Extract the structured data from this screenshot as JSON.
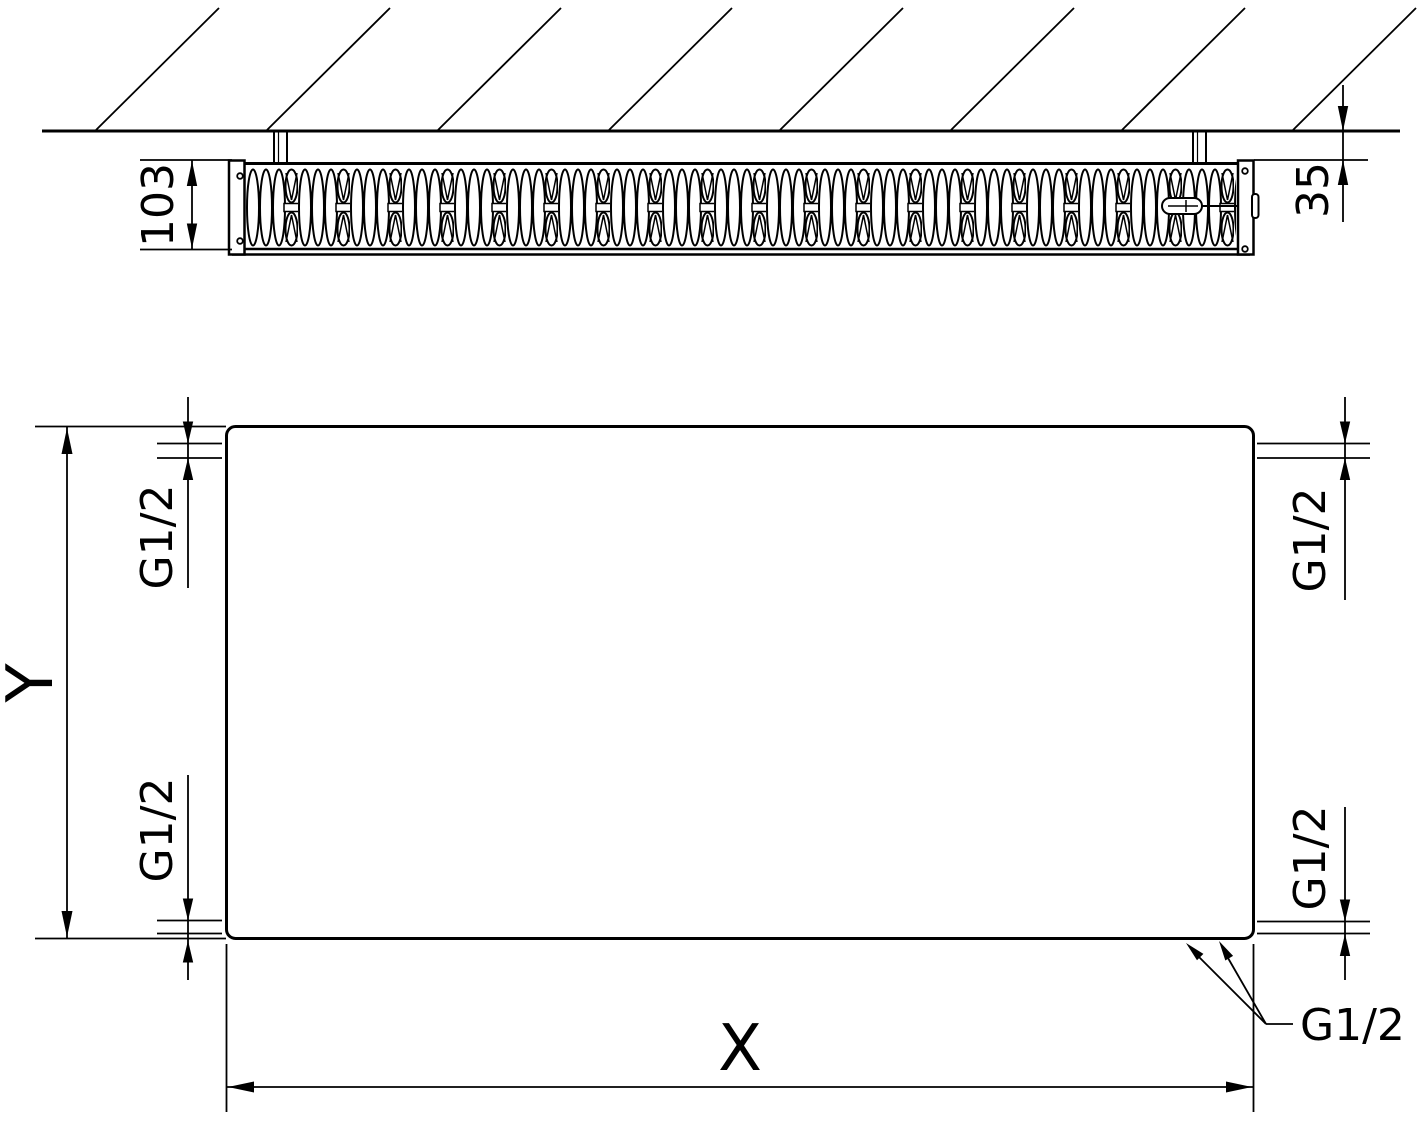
{
  "top_view": {
    "depth_dim_label": "103",
    "wall_gap_dim_label": "35"
  },
  "front_view": {
    "height_dim_label": "Y",
    "width_dim_label": "X",
    "connection_top_left_label": "G1/2",
    "connection_bottom_left_label": "G1/2",
    "connection_top_right_label": "G1/2",
    "connection_bottom_right_label": "G1/2",
    "bottom_connections_leader_label": "G1/2"
  },
  "colors": {
    "line": "#000000",
    "background": "#ffffff"
  }
}
